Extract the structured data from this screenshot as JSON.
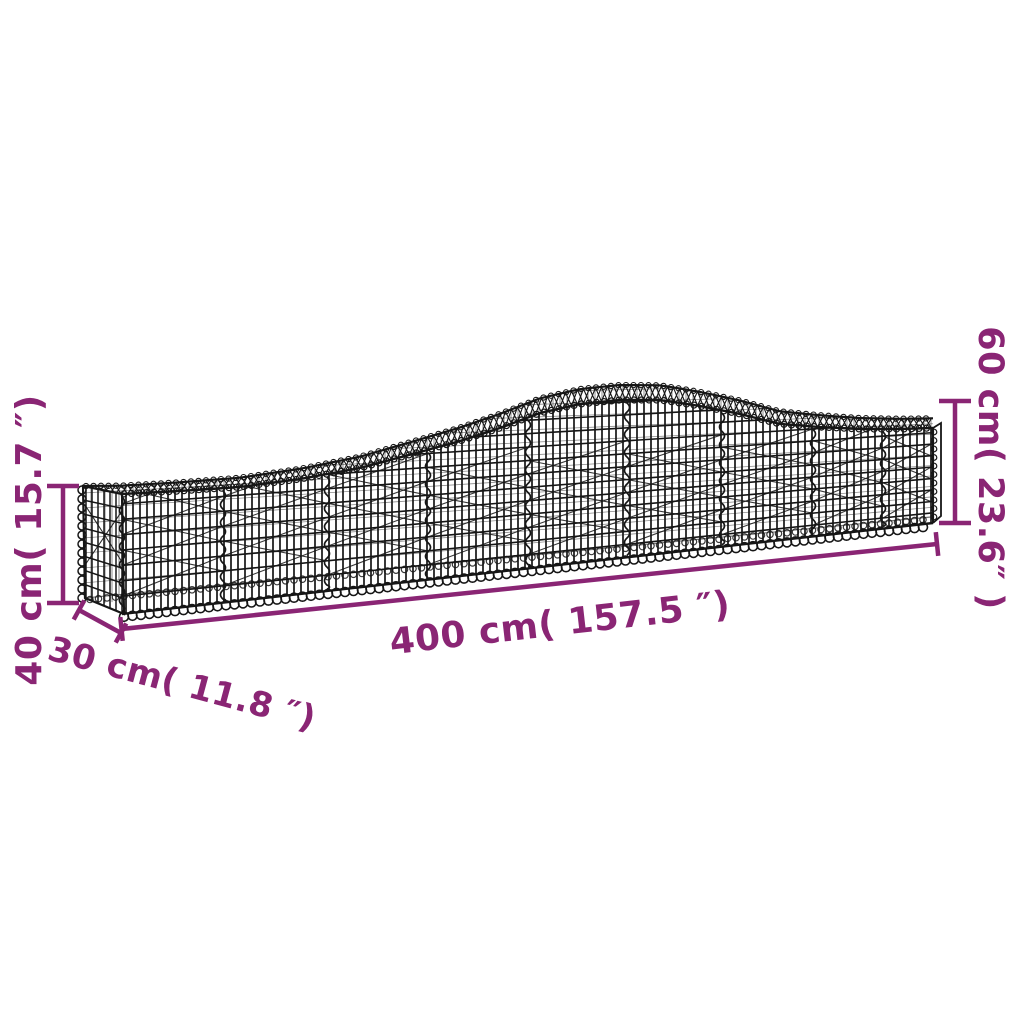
{
  "page": {
    "background_color": "#ffffff"
  },
  "diagram": {
    "subject": "arched-gabion-basket-dimension-drawing",
    "accent_color": "#8A2574",
    "wire_color": "#161616",
    "labels": {
      "length": "400 cm( 157.5 ″)",
      "depth": "30 cm( 11.8 ″)",
      "height_end": "40 cm( 15.7 ″)",
      "height_middle": "60 cm( 23.6″ )"
    },
    "values": {
      "length_cm": 400,
      "length_in": 157.5,
      "depth_cm": 30,
      "depth_in": 11.8,
      "height_end_cm": 40,
      "height_end_in": 15.7,
      "height_middle_cm": 60,
      "height_middle_in": 23.6
    }
  }
}
